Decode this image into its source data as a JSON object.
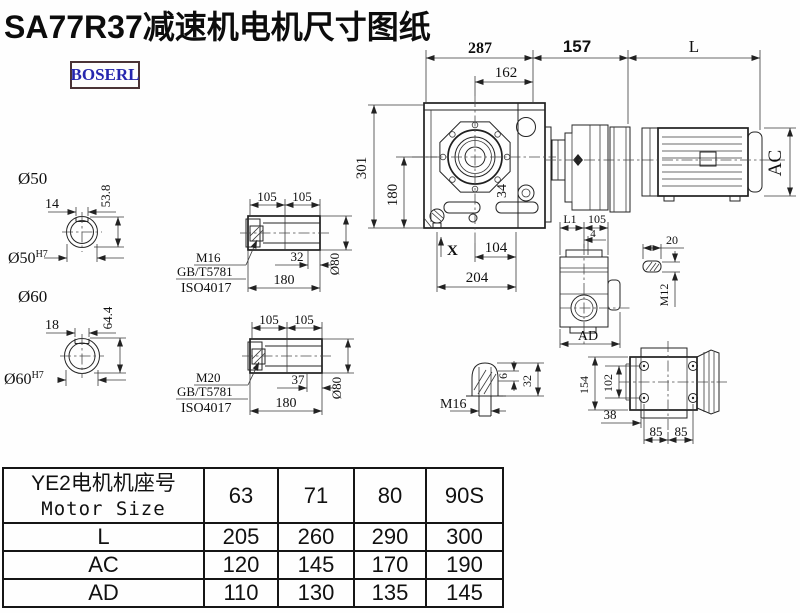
{
  "title": "SA77R37减速机电机尺寸图纸",
  "logo": "BOSERL",
  "colors": {
    "ink": "#1f1f1f",
    "logo_text": "#2626ae",
    "logo_border": "#4a3336"
  },
  "main_view": {
    "dim_top_width": "287",
    "dim_flange_width": "162",
    "dim_adapter_len": "157",
    "dim_motor_len": "L",
    "dim_total_height": "301",
    "dim_axis_height": "180",
    "dim_face": "34",
    "dim_x": "X",
    "dim_foot_span": "104",
    "dim_base_width": "204",
    "dim_motor_dia": "AC"
  },
  "shaft_sections": {
    "s50": {
      "label": "Ø50",
      "bore": "Ø50",
      "bore_sup": "H7",
      "key_width": "14",
      "key_height": "53.8"
    },
    "s60": {
      "label": "Ø60",
      "bore": "Ø60",
      "bore_sup": "H7",
      "key_width": "18",
      "key_height": "64.4"
    }
  },
  "hollow_shaft_a": {
    "dim_half_a": "105",
    "dim_half_b": "105",
    "dim_depth": "32",
    "dim_len": "180",
    "dim_dia": "Ø80",
    "thread": "M16",
    "std1": "GB/T5781",
    "std2": "ISO4017"
  },
  "hollow_shaft_b": {
    "dim_half_a": "105",
    "dim_half_b": "105",
    "dim_depth": "37",
    "dim_len": "180",
    "dim_dia": "Ø80",
    "thread": "M20",
    "std1": "GB/T5781",
    "std2": "ISO4017"
  },
  "side_view": {
    "dim_l1": "L1",
    "dim_105": "105",
    "dim_4": "4",
    "dim_ad": "AD"
  },
  "key_detail": {
    "dim_len": "20",
    "thread": "M12"
  },
  "plug_detail": {
    "thread": "M16",
    "dim_tip": "6",
    "dim_len": "32"
  },
  "rear_view": {
    "dim_height": "154",
    "dim_bolt_v": "102",
    "dim_offset": "38",
    "dim_bolt_h1": "85",
    "dim_bolt_h2": "85"
  },
  "table": {
    "header_line1": "YE2电机机座号",
    "header_line2": "Motor Size",
    "columns": [
      "63",
      "71",
      "80",
      "90S"
    ],
    "rows": [
      {
        "label": "L",
        "values": [
          "205",
          "260",
          "290",
          "300"
        ]
      },
      {
        "label": "AC",
        "values": [
          "120",
          "145",
          "170",
          "190"
        ]
      },
      {
        "label": "AD",
        "values": [
          "110",
          "130",
          "135",
          "145"
        ]
      }
    ]
  }
}
